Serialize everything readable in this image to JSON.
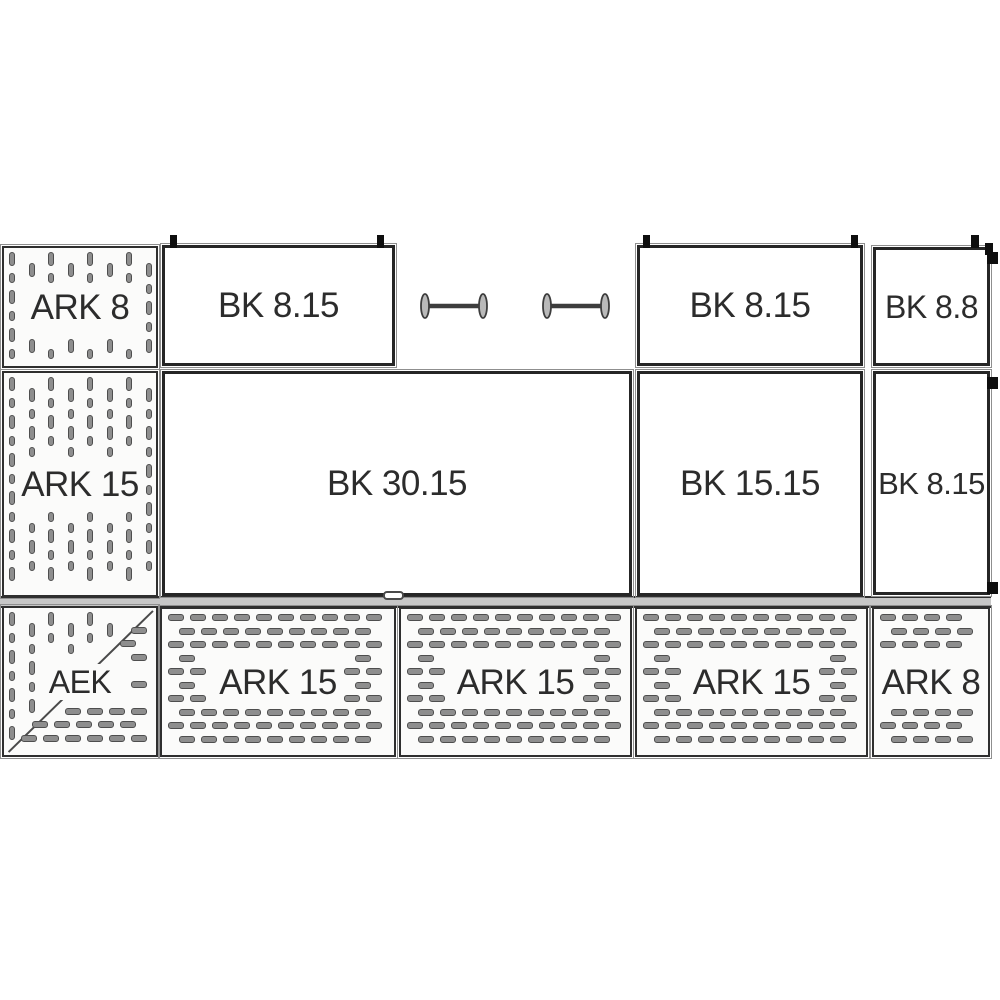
{
  "diagram": {
    "panels": {
      "ark8_left": {
        "label": "ARK 8"
      },
      "bk815_top_left": {
        "label": "BK 8.15"
      },
      "bk815_top_right": {
        "label": "BK 8.15"
      },
      "bk88_top": {
        "label": "BK 8.8"
      },
      "ark15_left": {
        "label": "ARK 15"
      },
      "bk3015": {
        "label": "BK 30.15"
      },
      "bk1515": {
        "label": "BK 15.15"
      },
      "bk815_mid_right": {
        "label": "BK 8.15"
      },
      "aek": {
        "label": "AEK"
      },
      "ark15_bottom_1": {
        "label": "ARK 15"
      },
      "ark15_bottom_2": {
        "label": "ARK 15"
      },
      "ark15_bottom_3": {
        "label": "ARK 15"
      },
      "ark8_bottom": {
        "label": "ARK 8"
      }
    },
    "icons": {
      "spreader_bar": "spreader-bar",
      "clip": "panel-clip"
    },
    "colors": {
      "line": "#2f2f2f",
      "dash_fill": "#8e8e8e",
      "dash_outline": "#4e4e4e",
      "strip_fill": "#c7c7c7",
      "text": "#2c2c2c",
      "clip": "#0e0e0e",
      "background": "#ffffff"
    }
  }
}
